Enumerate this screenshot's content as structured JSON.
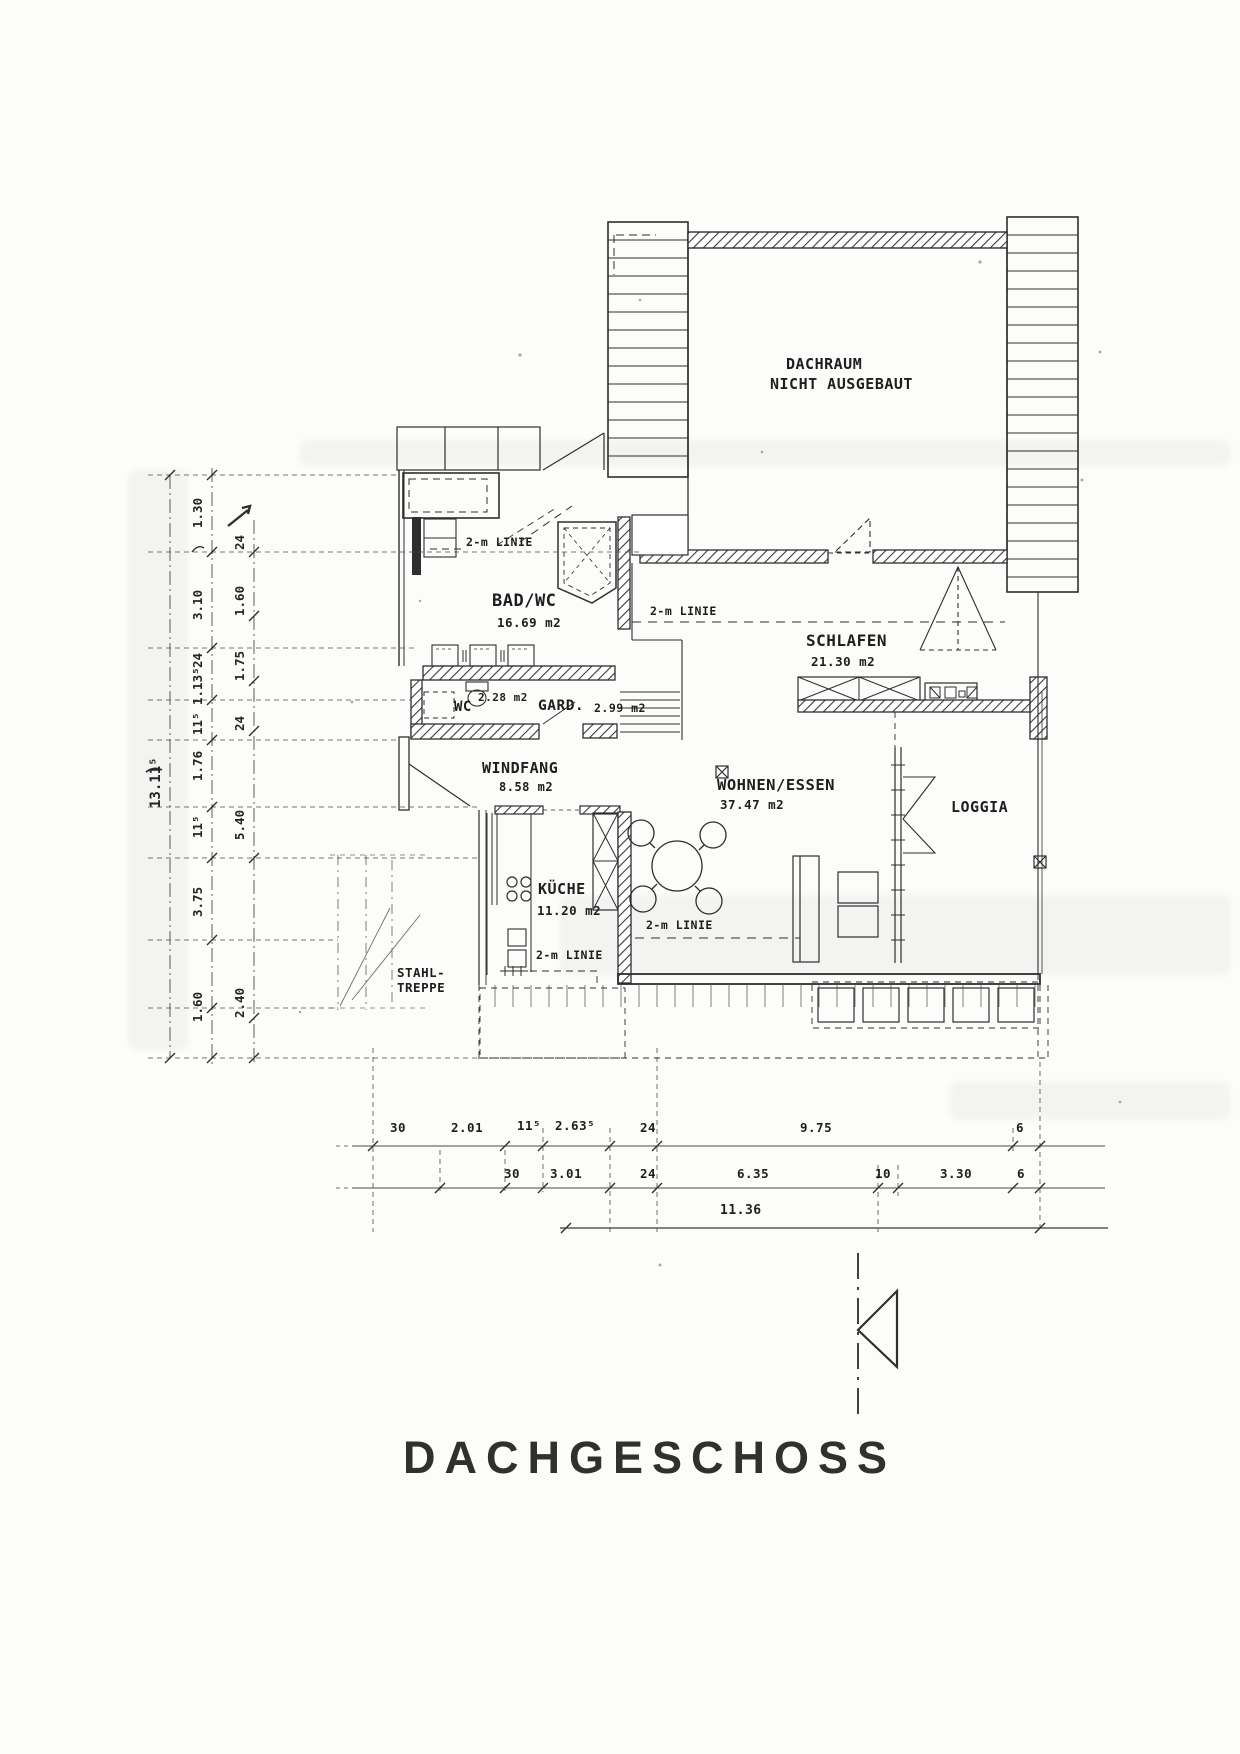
{
  "title": "DACHGESCHOSS",
  "labels": {
    "two_m_linie": "2-m LINIE"
  },
  "rooms": {
    "dachraum": {
      "line1": "DACHRAUM",
      "line2": "NICHT AUSGEBAUT"
    },
    "bad_wc": {
      "name": "BAD/WC",
      "area": "16.69 m2"
    },
    "schlafen": {
      "name": "SCHLAFEN",
      "area": "21.30 m2"
    },
    "wc": {
      "name": "WC",
      "area": "2.28 m2"
    },
    "gard": {
      "name": "GARD.",
      "area": "2.99 m2"
    },
    "windfang": {
      "name": "WINDFANG",
      "area": "8.58 m2"
    },
    "wohnen_essen": {
      "name": "WOHNEN/ESSEN",
      "area": "37.47 m2"
    },
    "loggia": {
      "name": "LOGGIA"
    },
    "kueche": {
      "name": "KÜCHE",
      "area": "11.20 m2"
    },
    "stahltreppe": {
      "line1": "STAHL-",
      "line2": "TREPPE"
    }
  },
  "dimensions": {
    "left_total": "13.11⁵",
    "left_inner": [
      "1.30",
      "3.10",
      "24",
      "1.13⁵",
      "11⁵",
      "1.76",
      "11⁵",
      "3.75",
      "1.60"
    ],
    "left_outer": [
      "24",
      "1.60",
      "1.75",
      "24",
      "5.40",
      "2.40"
    ],
    "bottom_row1": [
      "30",
      "2.01",
      "11⁵",
      "2.63⁵",
      "24",
      "9.75",
      "6"
    ],
    "bottom_row2": [
      "30",
      "3.01",
      "24",
      "6.35",
      "10",
      "3.30",
      "6"
    ],
    "bottom_total": "11.36"
  }
}
